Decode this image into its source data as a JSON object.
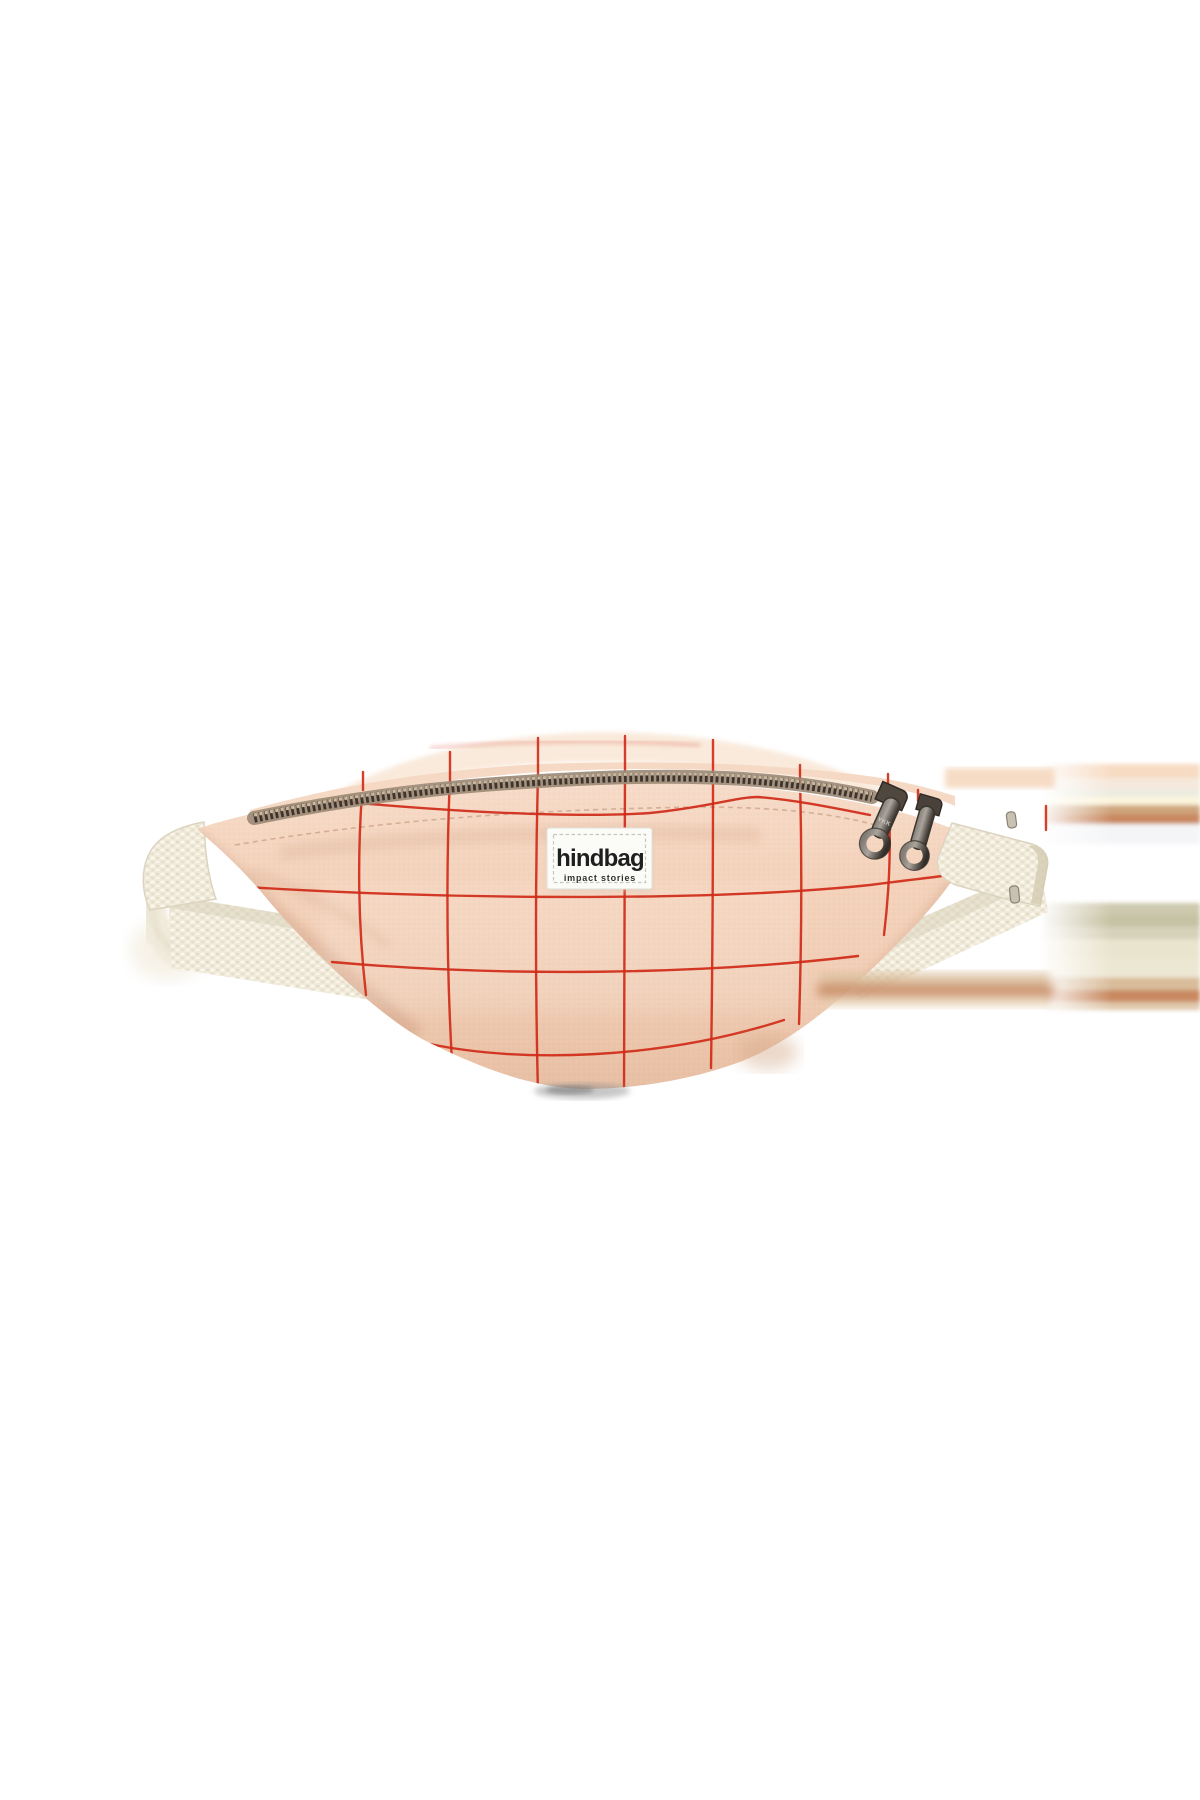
{
  "image": {
    "description": "Product photo of a peach pink canvas bum bag with red windowpane check, cream webbing strap and gunmetal double zipper, centered on a white background",
    "background": "#ffffff"
  },
  "label": {
    "brand": "hindbag",
    "tagline": "impact stories"
  },
  "zipper": {
    "pull_text": "YKK"
  },
  "colors": {
    "fabric": "#f3cfb6",
    "fabric_top": "#f6d9c4",
    "fabric_back": "#f9e9da",
    "grid": "#d02b18",
    "strap": "#f1ecdf",
    "teeth_base": "#9b8874",
    "teeth_dark": "#3e342c",
    "teeth_glint": "#d9c6ad",
    "pull_metal_dark": "#332e29",
    "label_bg": "#fbfbf8",
    "label_text": "#1f1f1f",
    "tagline_text": "#30302e"
  }
}
